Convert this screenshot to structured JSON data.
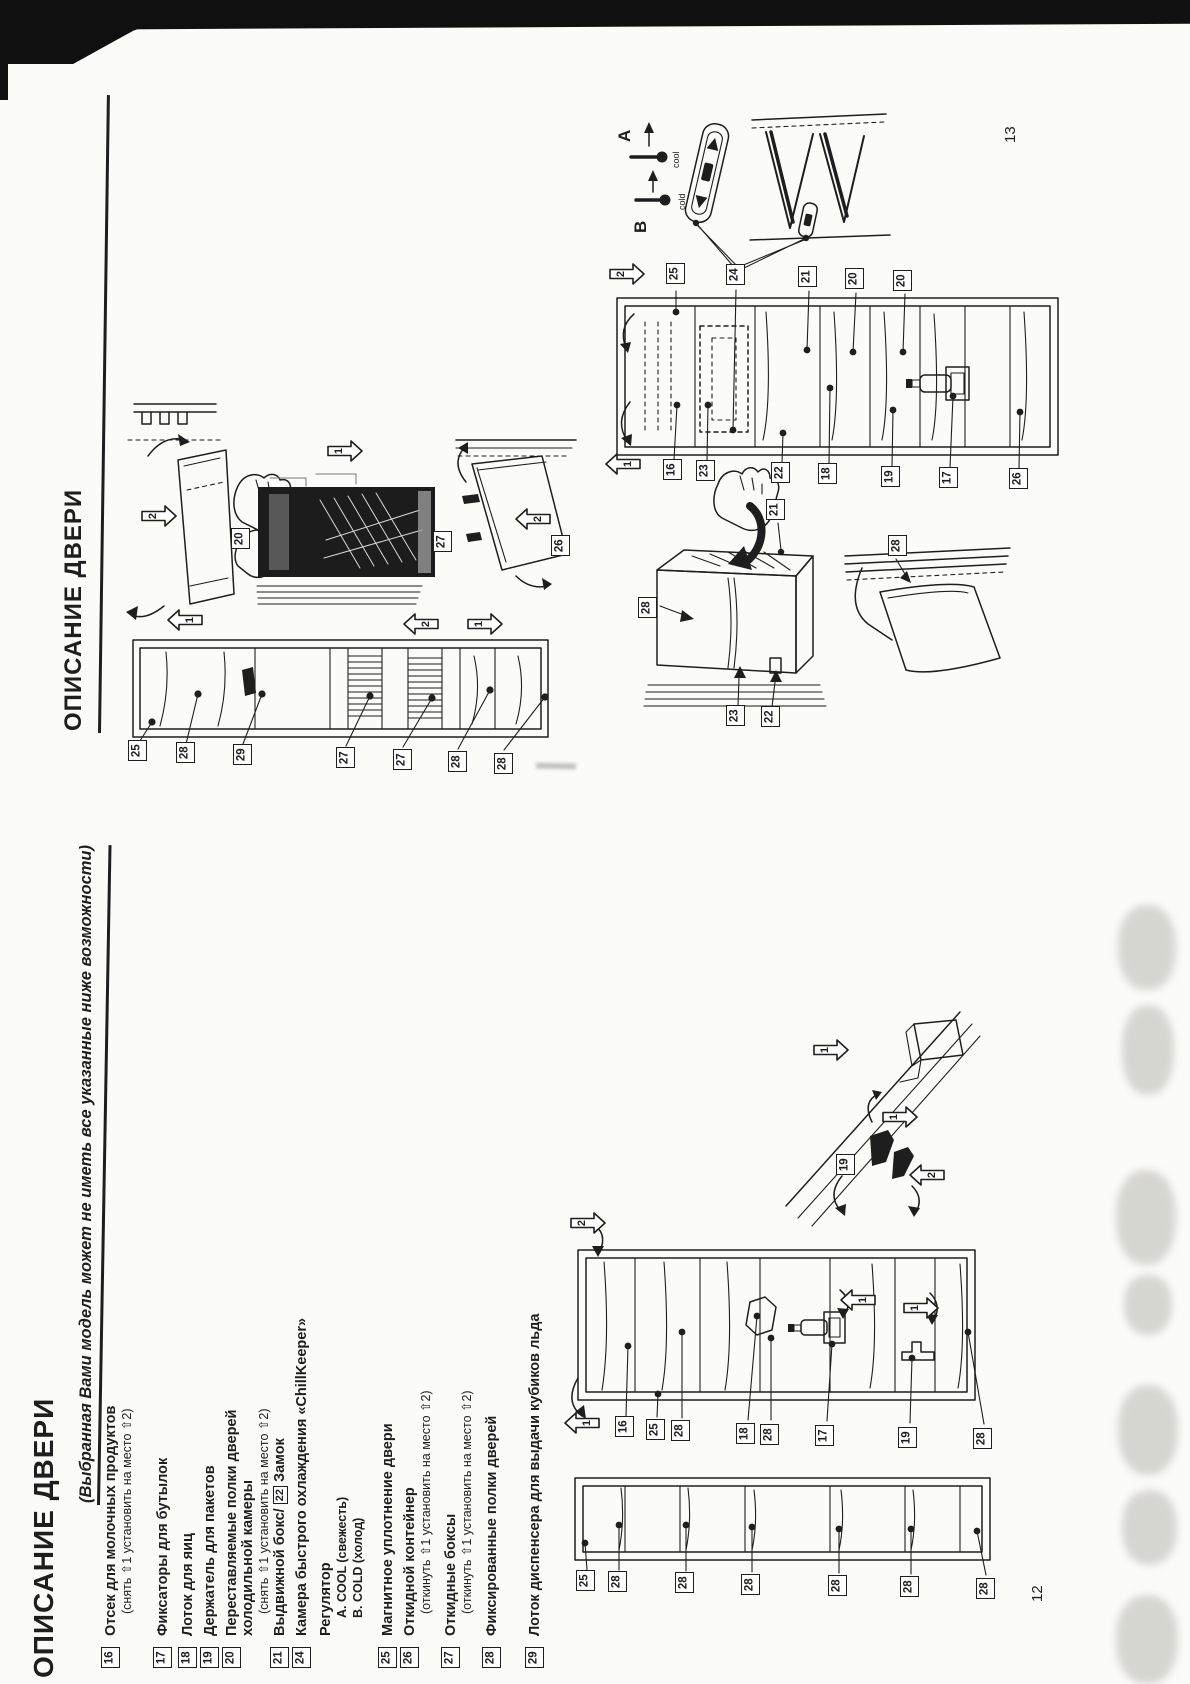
{
  "ink": "#1e1e1e",
  "document": {
    "page13": {
      "page_number": "13",
      "title": "ОПИСАНИЕ ДВЕРИ",
      "regulator": {
        "letter_a": "A",
        "letter_b": "B",
        "cool": "cool",
        "cold": "cold"
      }
    },
    "page12": {
      "page_number": "12",
      "title": "ОПИСАНИЕ ДВЕРИ",
      "subtitle": "(Выбранная Вами модель может не иметь все указанные ниже возможности)",
      "items": [
        {
          "num": "16",
          "x": 103,
          "title": "Отсек для молочных продуктов",
          "sub": "(снять ⇧1  установить на место ⇧2)"
        },
        {
          "num": "17",
          "x": 155,
          "title": "Фиксаторы для бутылок"
        },
        {
          "num": "18",
          "x": 180,
          "title": "Лоток для яиц"
        },
        {
          "num": "19",
          "x": 202,
          "title": "Держатель для пакетов"
        },
        {
          "num": "20",
          "x": 224,
          "title": "Переставляемые полки дверей",
          "title2": "холодильной камеры",
          "sub": "(снять ⇧1  установить на место ⇧2)"
        },
        {
          "num": "21",
          "x": 272,
          "pre": "Выдвижной бокс/ ",
          "box": "22",
          "post": " Замок"
        },
        {
          "num": "24",
          "x": 294,
          "title": "Камера быстрого охлаждения «ChillKeeper»"
        },
        {
          "x": 318,
          "title": "Регулятор",
          "subs": [
            "A.  COOL (свежесть)",
            "B.  COLD (холод)"
          ]
        },
        {
          "num": "25",
          "x": 380,
          "title": "Магнитное уплотнение двери"
        },
        {
          "num": "26",
          "x": 402,
          "title": "Откидной контейнер",
          "sub": "(откинуть ⇧1  установить на место ⇧2)"
        },
        {
          "num": "27",
          "x": 443,
          "title": "Откидные боксы",
          "sub": "(откинуть ⇧1  установить на место ⇧2)"
        },
        {
          "num": "28",
          "x": 484,
          "title": "Фиксированные полки дверей"
        },
        {
          "num": "29",
          "x": 527,
          "title": "Лоток диспенсера для выдачи кубиков льда"
        }
      ]
    }
  },
  "callouts": [
    {
      "t": "20",
      "x": 231,
      "y": 528
    },
    {
      "t": "27",
      "x": 433,
      "y": 531
    },
    {
      "t": "26",
      "x": 551,
      "y": 535
    },
    {
      "t": "25",
      "x": 128,
      "y": 740
    },
    {
      "t": "28",
      "x": 176,
      "y": 742
    },
    {
      "t": "29",
      "x": 233,
      "y": 744
    },
    {
      "t": "27",
      "x": 336,
      "y": 747
    },
    {
      "t": "27",
      "x": 393,
      "y": 749
    },
    {
      "t": "28",
      "x": 448,
      "y": 751
    },
    {
      "t": "28",
      "x": 494,
      "y": 753
    },
    {
      "t": "25",
      "x": 666,
      "y": 263
    },
    {
      "t": "24",
      "x": 726,
      "y": 264
    },
    {
      "t": "21",
      "x": 798,
      "y": 266
    },
    {
      "t": "20",
      "x": 845,
      "y": 268
    },
    {
      "t": "20",
      "x": 893,
      "y": 270
    },
    {
      "t": "16",
      "x": 663,
      "y": 459
    },
    {
      "t": "23",
      "x": 696,
      "y": 460
    },
    {
      "t": "22",
      "x": 771,
      "y": 462
    },
    {
      "t": "18",
      "x": 818,
      "y": 463
    },
    {
      "t": "19",
      "x": 881,
      "y": 466
    },
    {
      "t": "17",
      "x": 939,
      "y": 467
    },
    {
      "t": "26",
      "x": 1009,
      "y": 468
    },
    {
      "t": "21",
      "x": 766,
      "y": 499
    },
    {
      "t": "28",
      "x": 638,
      "y": 597
    },
    {
      "t": "23",
      "x": 726,
      "y": 705
    },
    {
      "t": "22",
      "x": 761,
      "y": 706
    },
    {
      "t": "28",
      "x": 888,
      "y": 535
    },
    {
      "t": "19",
      "x": 836,
      "y": 1154
    },
    {
      "t": "16",
      "x": 615,
      "y": 1416
    },
    {
      "t": "25",
      "x": 646,
      "y": 1419
    },
    {
      "t": "28",
      "x": 671,
      "y": 1420
    },
    {
      "t": "18",
      "x": 736,
      "y": 1423
    },
    {
      "t": "28",
      "x": 760,
      "y": 1424
    },
    {
      "t": "17",
      "x": 815,
      "y": 1425
    },
    {
      "t": "19",
      "x": 898,
      "y": 1427
    },
    {
      "t": "28",
      "x": 973,
      "y": 1428
    },
    {
      "t": "25",
      "x": 576,
      "y": 1570
    },
    {
      "t": "28",
      "x": 608,
      "y": 1571
    },
    {
      "t": "28",
      "x": 675,
      "y": 1572
    },
    {
      "t": "28",
      "x": 741,
      "y": 1574
    },
    {
      "t": "28",
      "x": 828,
      "y": 1575
    },
    {
      "t": "28",
      "x": 900,
      "y": 1576
    },
    {
      "t": "28",
      "x": 976,
      "y": 1578
    }
  ],
  "arrows": [
    {
      "t": "2",
      "x": 140,
      "y": 502,
      "dir": "right"
    },
    {
      "t": "1",
      "x": 166,
      "y": 606,
      "dir": "left"
    },
    {
      "t": "1",
      "x": 326,
      "y": 437,
      "dir": "right"
    },
    {
      "t": "2",
      "x": 402,
      "y": 610,
      "dir": "left"
    },
    {
      "t": "1",
      "x": 466,
      "y": 610,
      "dir": "right"
    },
    {
      "t": "2",
      "x": 514,
      "y": 505,
      "dir": "left"
    },
    {
      "t": "2",
      "x": 608,
      "y": 260,
      "dir": "right"
    },
    {
      "t": "1",
      "x": 604,
      "y": 450,
      "dir": "left"
    },
    {
      "t": "1",
      "x": 812,
      "y": 1036,
      "dir": "right"
    },
    {
      "t": "1",
      "x": 881,
      "y": 1103,
      "dir": "right"
    },
    {
      "t": "2",
      "x": 908,
      "y": 1161,
      "dir": "left"
    },
    {
      "t": "2",
      "x": 569,
      "y": 1209,
      "dir": "right"
    },
    {
      "t": "1",
      "x": 839,
      "y": 1286,
      "dir": "left"
    },
    {
      "t": "1",
      "x": 902,
      "y": 1294,
      "dir": "right"
    },
    {
      "t": "1",
      "x": 563,
      "y": 1409,
      "dir": "left"
    }
  ]
}
